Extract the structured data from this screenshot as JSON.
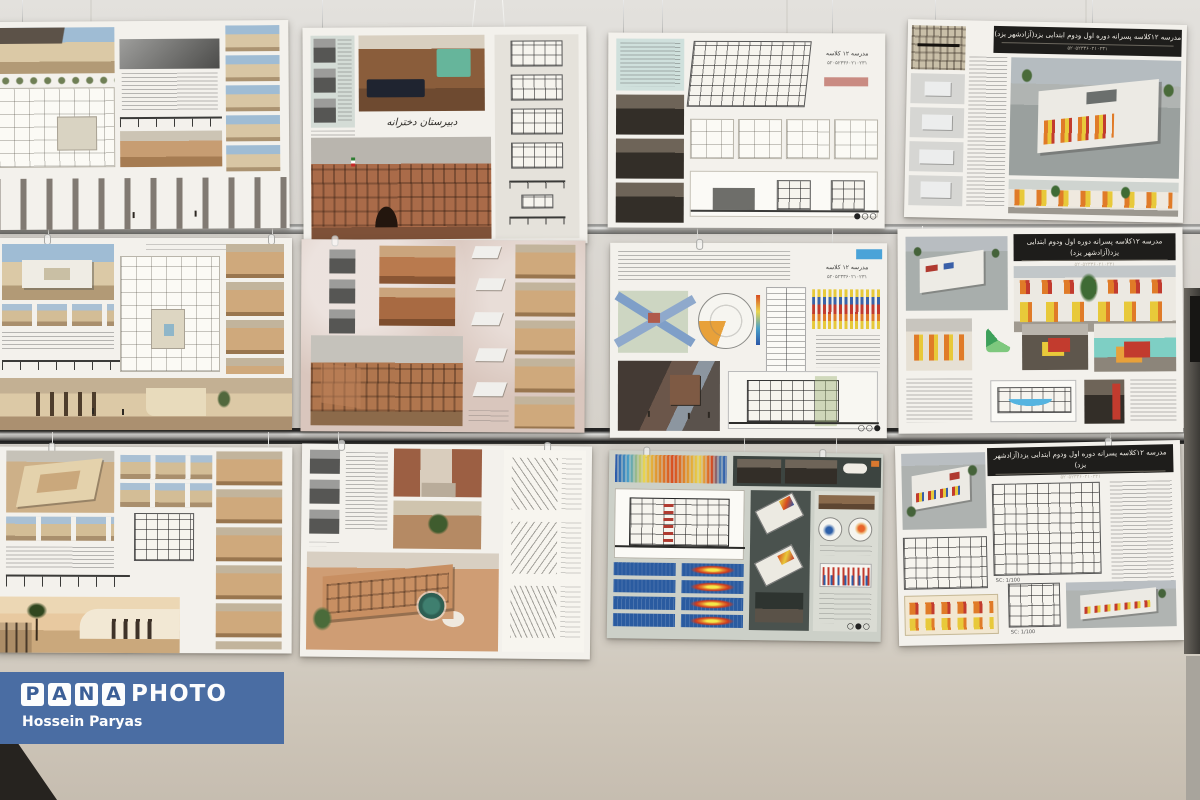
{
  "credit": {
    "brand_letters": [
      "P",
      "A",
      "N",
      "A"
    ],
    "brand_suffix": "PHOTO",
    "photographer": "Hossein Paryas",
    "banner_color": "#4a6da3"
  },
  "posters": {
    "school12_title": "مدرسه ۱۲کلاسه پسرانه دوره اول ودوم ابتدایی یزد(آزادشهر یزد)",
    "school12_code": "۵۲۰۵۲۳۳۶۰۲۱۰۲۳۱",
    "school12_short_title": "مدرسه ۱۲ کلاسه",
    "school12_short_code": "۵۲۰۵۲۳۳۶۰۲۱۰۲۳۱",
    "girls_school_calligraphy": "دبیرستان دخترانه",
    "scale_label": "SC: 1/100",
    "dots_r1c3": "●○○",
    "dots_r2c3": "○○●",
    "dots_r3c3": "○●○"
  }
}
